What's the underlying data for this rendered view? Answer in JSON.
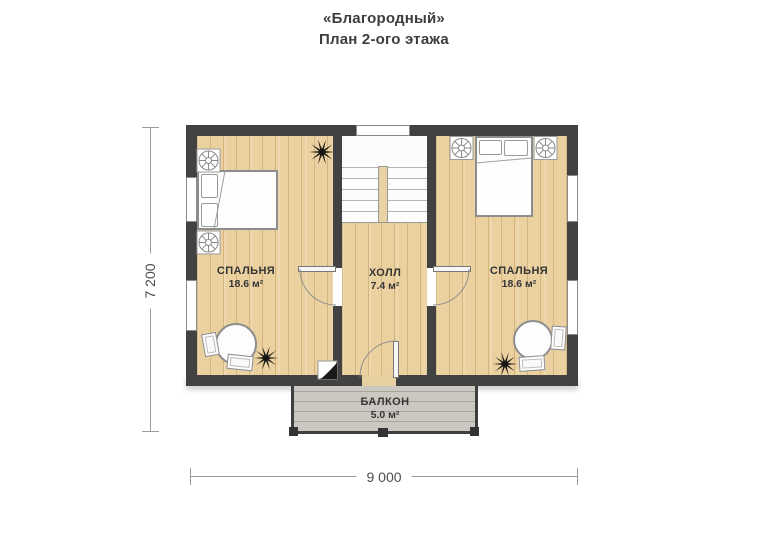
{
  "title": {
    "line1": "«Благородный»",
    "line2": "План 2-ого этажа"
  },
  "rooms": [
    {
      "name": "СПАЛЬНЯ",
      "area": "18.6 м²"
    },
    {
      "name": "ХОЛЛ",
      "area": "7.4 м²"
    },
    {
      "name": "СПАЛЬНЯ",
      "area": "18.6 м²"
    },
    {
      "name": "БАЛКОН",
      "area": "5.0 м²"
    }
  ],
  "dimensions": {
    "height": "7 200",
    "width": "9 000"
  },
  "icons": {
    "decor-star": "10-ray black starburst (svg path)",
    "bedside-table": "square with radial spoke circle (svg)",
    "folded-corner": "white square with black page-curl corner"
  },
  "colors": {
    "wall": "#424242",
    "floor": "#ebd1a0",
    "stairwell": "#fcfcfc",
    "balcony_floor": "#cbc8c2",
    "text": "#3d3d3d",
    "dimension_line": "#9a9a9a"
  }
}
